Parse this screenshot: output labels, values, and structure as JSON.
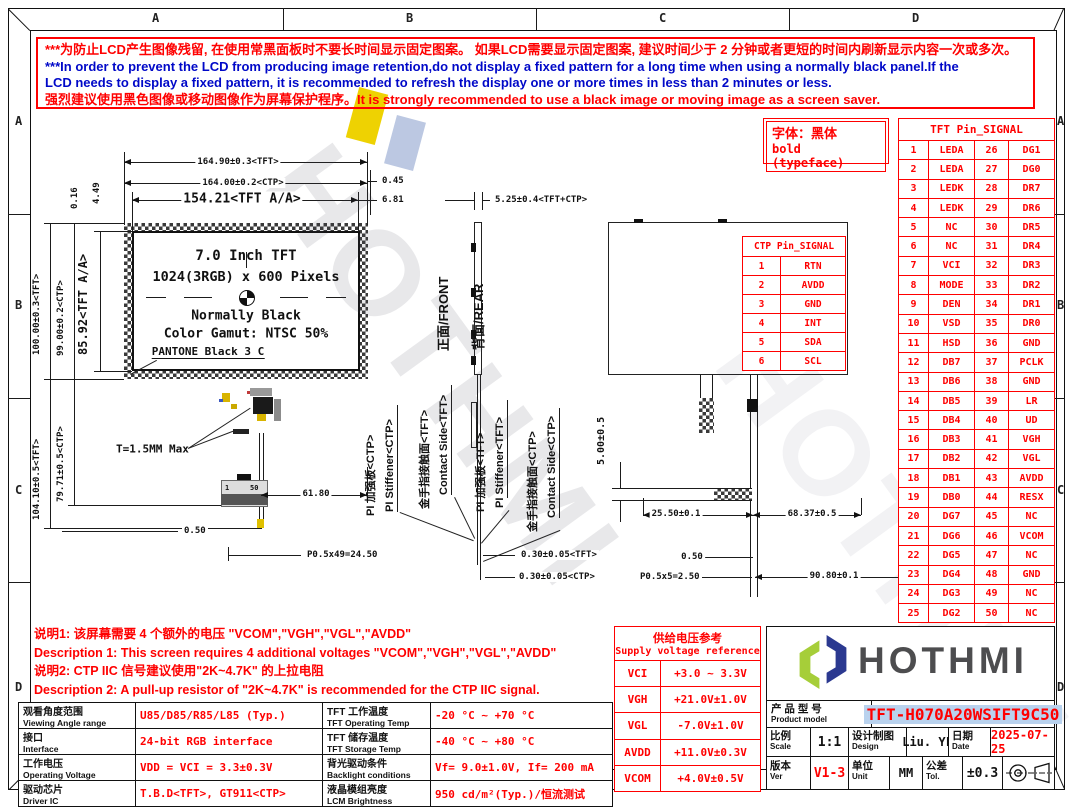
{
  "frame": {
    "cols": [
      "A",
      "B",
      "C",
      "D"
    ],
    "rows": [
      "A",
      "B",
      "C",
      "D"
    ]
  },
  "warning": {
    "line1": "***为防止LCD产生图像残留, 在使用常黑面板时不要长时间显示固定图案。 如果LCD需要显示固定图案, 建议时间少于 2 分钟或者更短的时间内刷新显示内容一次或多次。",
    "line2": "***In order to prevent the LCD from producing image retention,do not display a fixed pattern for a long time when using a normally black panel.If the",
    "line3": "LCD needs to display a fixed pattern, it is recommended to refresh the display one or more times in less than 2 minutes or less.",
    "line4": "强烈建议使用黑色图像或移动图像作为屏幕保护程序。It is strongly recommended to use a black image or moving image as a screen saver."
  },
  "font_note": {
    "cn": "字体：黑体",
    "en": "bold (typeface)"
  },
  "watermark": {
    "text": "HOTHMI"
  },
  "drawing": {
    "front": {
      "dim_width_tft": "164.90±0.3<TFT>",
      "dim_width_ctp": "164.00±0.2<CTP>",
      "dim_width_aa": "154.21<TFT A/A>",
      "off_right_ctp": "0.45",
      "off_right_aa": "6.81",
      "dim_h_tft": "100.00±0.3<TFT>",
      "dim_h_ctp": "99.00±0.2<CTP>",
      "dim_h_aa": "85.92<TFT A/A>",
      "dim_h_total": "104.10±0.5<TFT>",
      "dim_h_fpc": "79.71±0.5<CTP>",
      "off_top1": "4.49",
      "off_top2": "0.16",
      "label_size": "7.0 Inch TFT",
      "label_res": "1024(3RGB) x 600 Pixels",
      "label_mode": "Normally Black",
      "label_gamut": "Color Gamut: NTSC 50%",
      "label_pantone": "PANTONE Black 3 C",
      "label_thickness": "T=1.5MM Max",
      "dim_fpc_len": "61.80",
      "dim_pitch_start": "0.50",
      "dim_pitch": "P0.5x49=24.50",
      "dim_t_tft": "0.30±0.05<TFT>",
      "dim_t_ctp": "0.30±0.05<CTP>",
      "pin_first": "1",
      "pin_last": "50"
    },
    "side": {
      "dim_thickness": "5.25±0.4<TFT+CTP>",
      "label_front": "正面/FRONT",
      "label_rear": "背面/REAR",
      "callout_ctp_stiffener_cn": "PI 加强板<CTP>",
      "callout_ctp_stiffener_en": "PI Stiffener<CTP>",
      "callout_tft_contact_cn": "金手指接触面<TFT>",
      "callout_tft_contact_en": "Contact Side<TFT>",
      "callout_tft_stiffener_cn": "PI 加强板<TFT>",
      "callout_tft_stiffener_en": "PI Stiffener<TFT>",
      "callout_ctp_contact_cn": "金手指接触面<CTP>",
      "callout_ctp_contact_en": "Contact Side<CTP>"
    },
    "rear": {
      "dim_gap": "5.00±0.5",
      "dim_left": "25.50±0.1",
      "dim_right": "68.37±0.5",
      "dim_pin_start": "0.50",
      "dim_pitch": "P0.5x5=2.50",
      "dim_total": "90.80±0.1"
    }
  },
  "ctp_table": {
    "title": "CTP Pin_SIGNAL",
    "rows": [
      [
        "1",
        "RTN"
      ],
      [
        "2",
        "AVDD"
      ],
      [
        "3",
        "GND"
      ],
      [
        "4",
        "INT"
      ],
      [
        "5",
        "SDA"
      ],
      [
        "6",
        "SCL"
      ]
    ]
  },
  "tft_table": {
    "title": "TFT Pin_SIGNAL",
    "rows": [
      [
        "1",
        "LEDA",
        "26",
        "DG1"
      ],
      [
        "2",
        "LEDA",
        "27",
        "DG0"
      ],
      [
        "3",
        "LEDK",
        "28",
        "DR7"
      ],
      [
        "4",
        "LEDK",
        "29",
        "DR6"
      ],
      [
        "5",
        "NC",
        "30",
        "DR5"
      ],
      [
        "6",
        "NC",
        "31",
        "DR4"
      ],
      [
        "7",
        "VCI",
        "32",
        "DR3"
      ],
      [
        "8",
        "MODE",
        "33",
        "DR2"
      ],
      [
        "9",
        "DEN",
        "34",
        "DR1"
      ],
      [
        "10",
        "VSD",
        "35",
        "DR0"
      ],
      [
        "11",
        "HSD",
        "36",
        "GND"
      ],
      [
        "12",
        "DB7",
        "37",
        "PCLK"
      ],
      [
        "13",
        "DB6",
        "38",
        "GND"
      ],
      [
        "14",
        "DB5",
        "39",
        "LR"
      ],
      [
        "15",
        "DB4",
        "40",
        "UD"
      ],
      [
        "16",
        "DB3",
        "41",
        "VGH"
      ],
      [
        "17",
        "DB2",
        "42",
        "VGL"
      ],
      [
        "18",
        "DB1",
        "43",
        "AVDD"
      ],
      [
        "19",
        "DB0",
        "44",
        "RESX"
      ],
      [
        "20",
        "DG7",
        "45",
        "NC"
      ],
      [
        "21",
        "DG6",
        "46",
        "VCOM"
      ],
      [
        "22",
        "DG5",
        "47",
        "NC"
      ],
      [
        "23",
        "DG4",
        "48",
        "GND"
      ],
      [
        "24",
        "DG3",
        "49",
        "NC"
      ],
      [
        "25",
        "DG2",
        "50",
        "NC"
      ]
    ]
  },
  "supply_table": {
    "title_cn": "供给电压参考",
    "title_en": "Supply voltage reference",
    "rows": [
      [
        "VCI",
        "+3.0 ~ 3.3V"
      ],
      [
        "VGH",
        "+21.0V±1.0V"
      ],
      [
        "VGL",
        "-7.0V±1.0V"
      ],
      [
        "AVDD",
        "+11.0V±0.3V"
      ],
      [
        "VCOM",
        "+4.0V±0.5V"
      ]
    ]
  },
  "notes": {
    "n1_cn": "说明1: 该屏幕需要 4 个额外的电压 \"VCOM\",\"VGH\",\"VGL\",\"AVDD\"",
    "n1_en": "Description 1: This screen requires 4 additional voltages \"VCOM\",\"VGH\",\"VGL\",\"AVDD\"",
    "n2_cn": "说明2: CTP IIC 信号建议使用\"2K~4.7K\" 的上拉电阻",
    "n2_en": "Description 2: A pull-up resistor of \"2K~4.7K\" is recommended for the CTP IIC signal."
  },
  "spec_table": {
    "rows": [
      {
        "p1_cn": "观看角度范围",
        "p1_en": "Viewing Angle range",
        "v1": "U85/D85/R85/L85 (Typ.)",
        "p2_cn": "TFT 工作温度",
        "p2_en": "TFT Operating Temp",
        "v2": "-20 °C ~ +70 °C"
      },
      {
        "p1_cn": "接口",
        "p1_en": "Interface",
        "v1": "24-bit RGB interface",
        "p2_cn": "TFT 储存温度",
        "p2_en": "TFT Storage Temp",
        "v2": "-40 °C ~ +80 °C"
      },
      {
        "p1_cn": "工作电压",
        "p1_en": "Operating Voltage",
        "v1": "VDD = VCI = 3.3±0.3V",
        "p2_cn": "背光驱动条件",
        "p2_en": "Backlight conditions",
        "v2": "Vf= 9.0±1.0V, If= 200 mA"
      },
      {
        "p1_cn": "驱动芯片",
        "p1_en": "Driver IC",
        "v1": "T.B.D<TFT>, GT911<CTP>",
        "p2_cn": "液晶模组亮度",
        "p2_en": "LCM Brightness",
        "v2": "950 cd/m²(Typ.)/恒流测试"
      }
    ]
  },
  "title_block": {
    "brand": "HOTHMI",
    "product_label_cn": "产 品 型 号",
    "product_label_en": "Product model",
    "model": "TFT-H070A20WSIFT9C50",
    "scale_cn": "比例",
    "scale_en": "Scale",
    "scale": "1:1",
    "design_cn": "设计制图",
    "design_en": "Design",
    "designer": "Liu. YL",
    "date_cn": "日期",
    "date_en": "Date",
    "date": "2025-07-25",
    "ver_cn": "版本",
    "ver_en": "Ver",
    "version": "V1-3",
    "unit_cn": "单位",
    "unit_en": "Unit",
    "unit": "MM",
    "tol_cn": "公差",
    "tol_en": "Tol.",
    "tolerance": "±0.3"
  },
  "colors": {
    "warning_red": "#ff0000",
    "warning_blue": "#0008c8",
    "table_red": "#ff0000",
    "logo_green": "#a6ce39",
    "logo_navy": "#2b3990",
    "logo_gray": "#4d4d4f",
    "model_highlight": "#b9d2ee"
  }
}
